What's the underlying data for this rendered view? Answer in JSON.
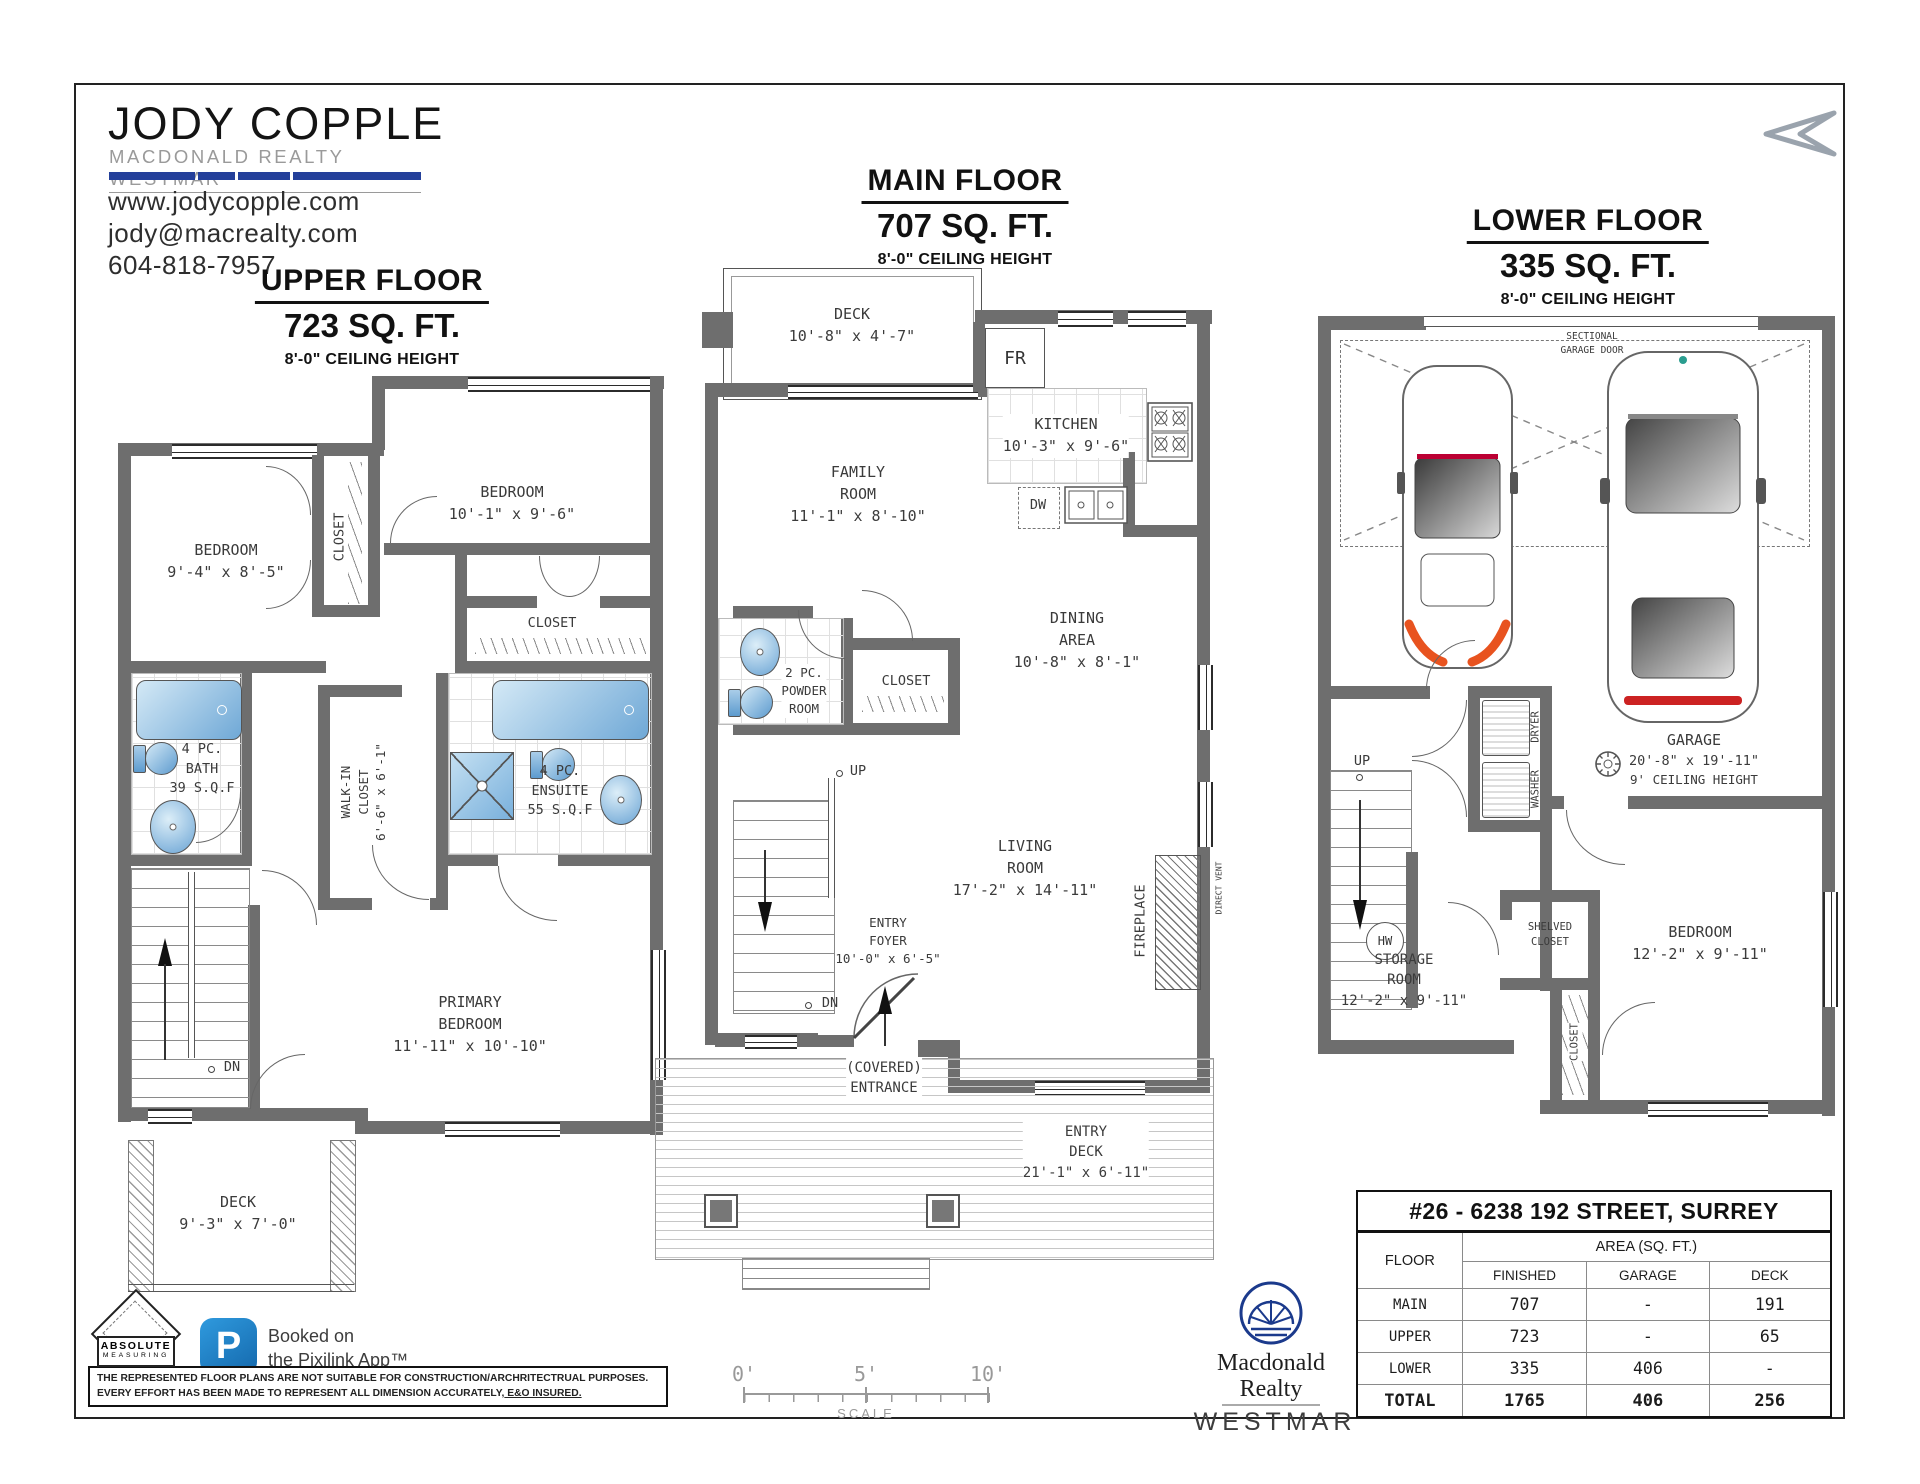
{
  "branding": {
    "name": "JODY COPPLE",
    "tagline": "MACDONALD REALTY WESTMAR",
    "website": "www.jodycopple.com",
    "email": "jody@macrealty.com",
    "phone": "604-818-7957"
  },
  "icons": {
    "north_arrow": "stylized-left-arrow",
    "pixilink_app": "blue-rounded-P-app-icon",
    "absolute_measuring": "diamond-ruler-logo",
    "macdonald_realty": "navy-fan-circle-logo"
  },
  "colors": {
    "wall_gray": "#6e6e6e",
    "brand_blue": "#24409a",
    "fixture_blue": "#6fa8d6",
    "pixilink_blue": "#2189cf",
    "realty_navy": "#1b3a8c",
    "car_accent_orange": "#e8531f"
  },
  "floors": {
    "upper": {
      "title": "UPPER FLOOR",
      "area": "723 SQ. FT.",
      "ceiling": "8'-0\" CEILING HEIGHT",
      "rooms": {
        "bedroom_left": {
          "l1": "BEDROOM",
          "l2": "9'-4\" x 8'-5\""
        },
        "bedroom_right": {
          "l1": "BEDROOM",
          "l2": "10'-1\" x 9'-6\""
        },
        "closet_mid": "CLOSET",
        "closet_right": "CLOSET",
        "bath": {
          "l1": "4 PC.",
          "l2": "BATH",
          "l3": "39 S.Q.F"
        },
        "walkin": {
          "l1": "WALK-IN",
          "l2": "CLOSET",
          "l3": "6'-6\" x 6'-1\""
        },
        "ensuite": {
          "l1": "4 PC.",
          "l2": "ENSUITE",
          "l3": "55 S.Q.F"
        },
        "primary": {
          "l1": "PRIMARY",
          "l2": "BEDROOM",
          "l3": "11'-11\" x 10'-10\""
        },
        "deck": {
          "l1": "DECK",
          "l2": "9'-3\" x 7'-0\""
        },
        "dn": "DN"
      }
    },
    "main": {
      "title": "MAIN FLOOR",
      "area": "707 SQ. FT.",
      "ceiling": "8'-0\" CEILING HEIGHT",
      "rooms": {
        "deck": {
          "l1": "DECK",
          "l2": "10'-8\" x 4'-7\""
        },
        "fr": "FR",
        "kitchen": {
          "l1": "KITCHEN",
          "l2": "10'-3\" x 9'-6\""
        },
        "dw": "DW",
        "family": {
          "l1": "FAMILY",
          "l2": "ROOM",
          "l3": "11'-1\" x 8'-10\""
        },
        "powder": {
          "l1": "2 PC.",
          "l2": "POWDER",
          "l3": "ROOM"
        },
        "closet": "CLOSET",
        "dining": {
          "l1": "DINING",
          "l2": "AREA",
          "l3": "10'-8\" x 8'-1\""
        },
        "up": "UP",
        "dn": "DN",
        "living": {
          "l1": "LIVING",
          "l2": "ROOM",
          "l3": "17'-2\" x 14'-11\""
        },
        "fireplace": "FIREPLACE",
        "direct_vent": "DIRECT VENT",
        "foyer": {
          "l1": "ENTRY",
          "l2": "FOYER",
          "l3": "10'-0\" x 6'-5\""
        },
        "covered": {
          "l1": "(COVERED)",
          "l2": "ENTRANCE"
        },
        "entry_deck": {
          "l1": "ENTRY",
          "l2": "DECK",
          "l3": "21'-1\" x 6'-11\""
        }
      }
    },
    "lower": {
      "title": "LOWER FLOOR",
      "area": "335 SQ. FT.",
      "ceiling": "8'-0\" CEILING HEIGHT",
      "rooms": {
        "sectional": {
          "l1": "SECTIONAL",
          "l2": "GARAGE DOOR"
        },
        "garage": {
          "l1": "GARAGE",
          "l2": "20'-8\" x 19'-11\"",
          "l3": "9' CEILING HEIGHT"
        },
        "dryer": "DRYER",
        "washer": "WASHER",
        "up": "UP",
        "hw": "HW",
        "shelved": {
          "l1": "SHELVED",
          "l2": "CLOSET"
        },
        "storage": {
          "l1": "STORAGE",
          "l2": "ROOM",
          "l3": "12'-2\" x 9'-11\""
        },
        "closet": "CLOSET",
        "bedroom": {
          "l1": "BEDROOM",
          "l2": "12'-2\" x 9'-11\""
        }
      }
    }
  },
  "scale_bar": {
    "ticks": [
      "0'",
      "5'",
      "10'"
    ],
    "caption": "SCALE"
  },
  "measuring_logo": {
    "line1": "ABSOLUTE",
    "line2": "MEASURING"
  },
  "pixilink": {
    "icon_letter": "P",
    "line1": "Booked on",
    "line2": "the Pixilink App™"
  },
  "disclaimer": {
    "line1": "THE REPRESENTED FLOOR PLANS ARE NOT SUITABLE FOR CONSTRUCTION/ARCHRITECTRUAL PURPOSES.",
    "line2_text": "EVERY EFFORT HAS BEEN MADE TO REPRESENT ALL DIMENSION ACCURATELY,",
    "line2_underlined": " E&O INSURED."
  },
  "realty": {
    "name_line1": "Macdonald",
    "name_line2": "Realty",
    "brand": "WESTMAR"
  },
  "summary": {
    "address": "#26 - 6238 192 STREET, SURREY",
    "floor_col": "FLOOR",
    "area_header": "AREA (SQ. FT.)",
    "columns": [
      "FINISHED",
      "GARAGE",
      "DECK"
    ],
    "rows": [
      {
        "floor": "MAIN",
        "finished": "707",
        "garage": "-",
        "deck": "191"
      },
      {
        "floor": "UPPER",
        "finished": "723",
        "garage": "-",
        "deck": "65"
      },
      {
        "floor": "LOWER",
        "finished": "335",
        "garage": "406",
        "deck": "-"
      },
      {
        "floor": "TOTAL",
        "finished": "1765",
        "garage": "406",
        "deck": "256"
      }
    ]
  }
}
